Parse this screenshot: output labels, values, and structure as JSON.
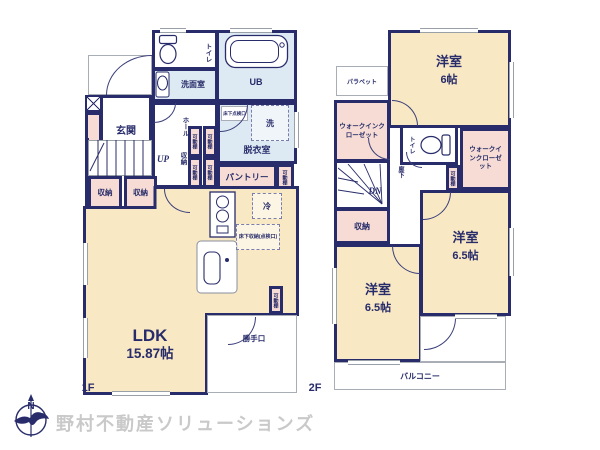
{
  "footer": {
    "brand": "野村不動産ソリューションズ",
    "compass_n": "N"
  },
  "f1": {
    "floor_label": "1F",
    "toilet": "トイレ",
    "washroom": "洗面室",
    "unit_bath": "UB",
    "entrance": "玄関",
    "hall": "ホール",
    "stairs_up": "UP",
    "closet": "収納",
    "movable_shelf": "可動棚",
    "underfloor_inspection": "床下点検口",
    "washer": "洗",
    "dressing_room": "脱衣室",
    "pantry": "パントリー",
    "fridge": "冷",
    "underfloor_storage": "床下収納(点検口)",
    "ldk_name": "LDK",
    "ldk_size": "15.87帖",
    "back_door": "勝手口"
  },
  "f2": {
    "floor_label": "2F",
    "parapet": "パラペット",
    "walk_in_closet": "ウォークインクローゼット",
    "toilet": "トイレ",
    "corridor": "廊下",
    "movable_shelf": "可動棚",
    "stairs_down": "DN",
    "closet": "収納",
    "rooms": [
      {
        "name": "洋室",
        "size": "6帖"
      },
      {
        "name": "洋室",
        "size": "6.5帖"
      },
      {
        "name": "洋室",
        "size": "6.5帖"
      }
    ],
    "balcony": "バルコニー"
  },
  "colors": {
    "wall_navy": "#282c6a",
    "room_cream": "#f8e8c4",
    "closet_pink": "#f6dcd4",
    "wet_area_blue": "#dde9f3",
    "logo_gray": "#c9c9c9"
  }
}
